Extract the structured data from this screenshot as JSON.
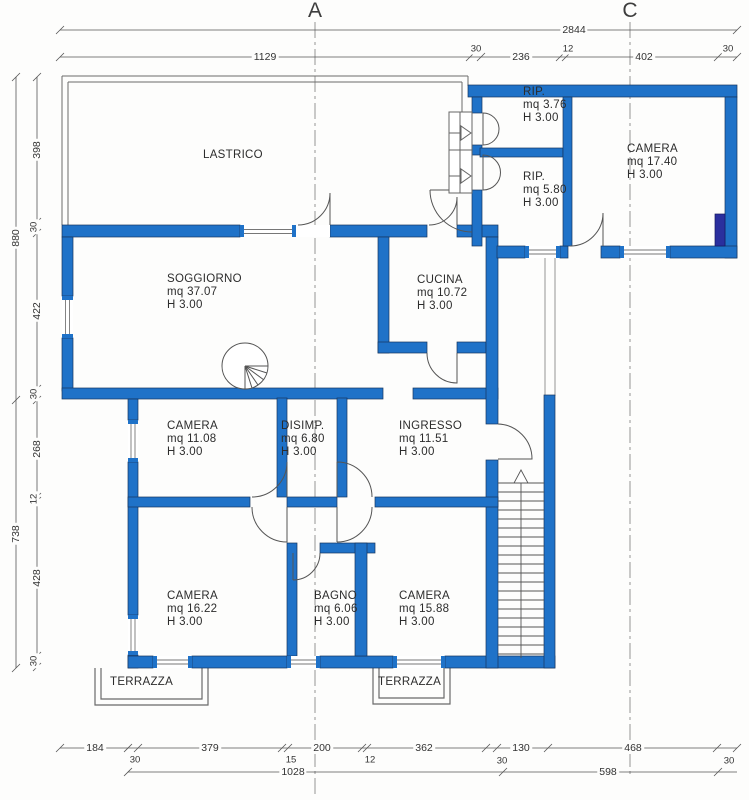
{
  "section_labels": {
    "a": "A",
    "c": "C"
  },
  "rooms": {
    "lastrico": {
      "name": "LASTRICO"
    },
    "rip1": {
      "name": "RIP.",
      "area": "mq 3.76",
      "height": "H 3.00"
    },
    "camera1": {
      "name": "CAMERA",
      "area": "mq 17.40",
      "height": "H 3.00"
    },
    "rip2": {
      "name": "RIP.",
      "area": "mq 5.80",
      "height": "H 3.00"
    },
    "soggiorno": {
      "name": "SOGGIORNO",
      "area": "mq 37.07",
      "height": "H 3.00"
    },
    "cucina": {
      "name": "CUCINA",
      "area": "mq 10.72",
      "height": "H 3.00"
    },
    "camera2": {
      "name": "CAMERA",
      "area": "mq 11.08",
      "height": "H 3.00"
    },
    "disimp": {
      "name": "DISIMP.",
      "area": "mq 6.80",
      "height": "H 3.00"
    },
    "ingresso": {
      "name": "INGRESSO",
      "area": "mq 11.51",
      "height": "H 3.00"
    },
    "camera3": {
      "name": "CAMERA",
      "area": "mq 16.22",
      "height": "H 3.00"
    },
    "bagno": {
      "name": "BAGNO",
      "area": "mq 6.06",
      "height": "H 3.00"
    },
    "camera4": {
      "name": "CAMERA",
      "area": "mq 15.88",
      "height": "H 3.00"
    },
    "terrazza1": {
      "name": "TERRAZZA"
    },
    "terrazza2": {
      "name": "TERRAZZA"
    }
  },
  "dimensions": {
    "top_total": "2844",
    "top_chain": [
      "1129",
      "30",
      "236",
      "12",
      "402",
      "30"
    ],
    "left_totals": [
      "880",
      "738"
    ],
    "left_chain": [
      "398",
      "30",
      "422",
      "30",
      "268",
      "12",
      "428",
      "30"
    ],
    "bottom_chain_main": [
      "184",
      "379",
      "200",
      "362",
      "130",
      "468"
    ],
    "bottom_chain_small": [
      "30",
      "15",
      "12",
      "30",
      "30"
    ],
    "bottom_row2": [
      "1028",
      "598"
    ]
  },
  "colors": {
    "wall_blue": "#1f72c8",
    "window_pier_navy": "#2a2f9e",
    "line_gray": "#555555"
  }
}
